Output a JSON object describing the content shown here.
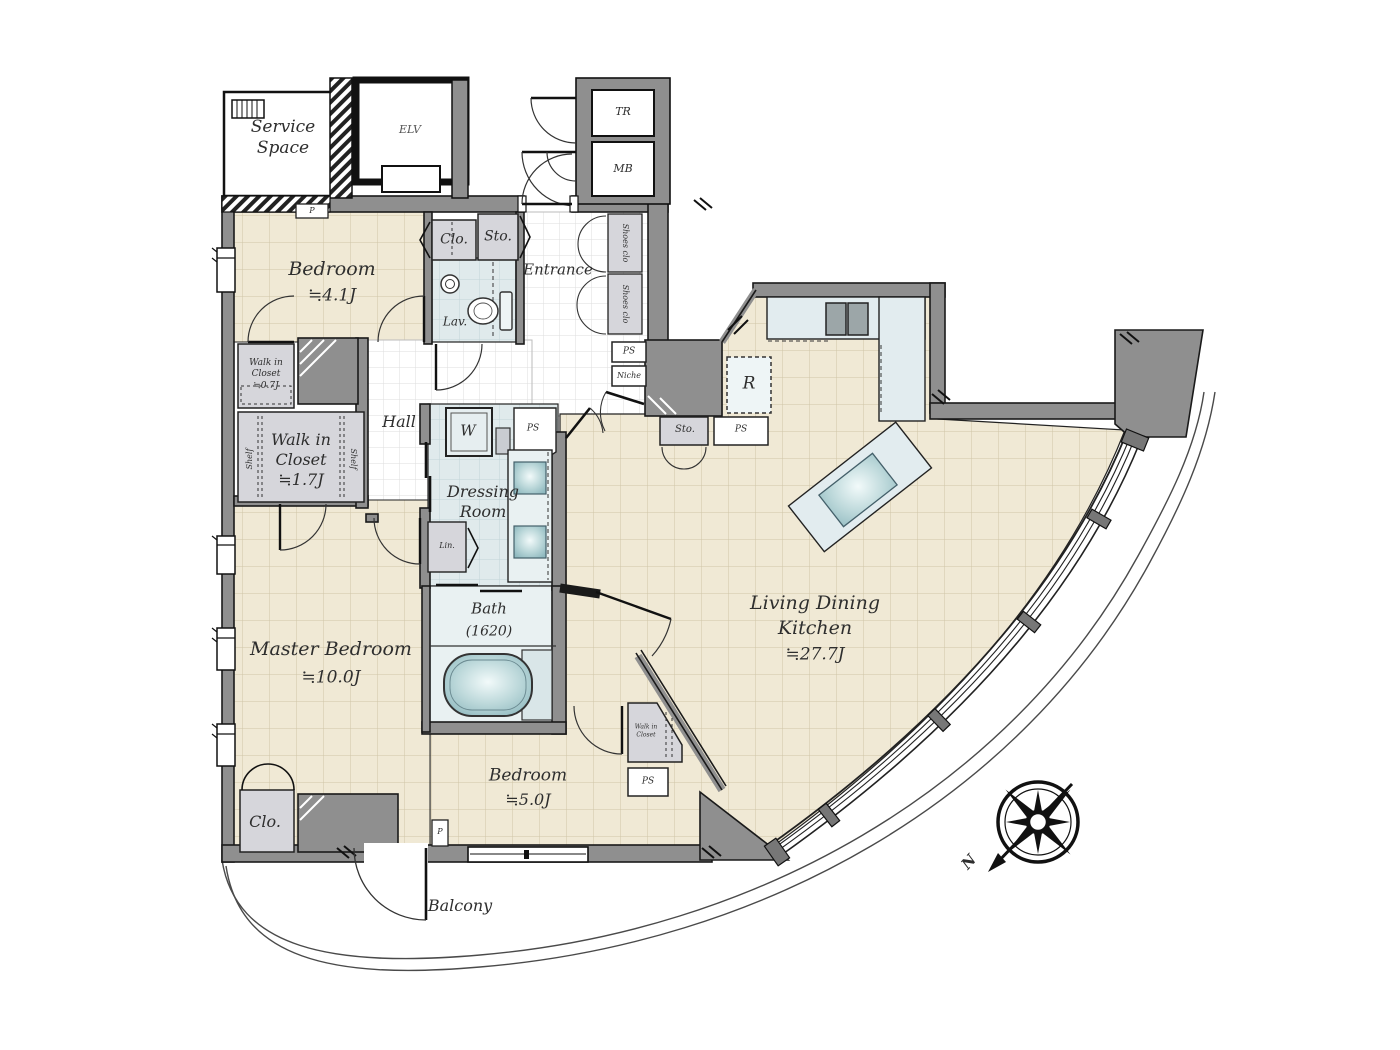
{
  "title": "apartment-floor-plan",
  "colors": {
    "wall": "#8f8f8f",
    "wall_outline": "#1a1a1a",
    "floor_beige": "#f0e9d5",
    "floor_grid": "#cfc5a8",
    "wet_blue": "#e2ecef",
    "closet_gray": "#d6d6db",
    "fixture_teal": "#9fc2c7"
  },
  "labels": {
    "service_space": {
      "line1": "Service",
      "line2": "Space"
    },
    "elv": "ELV",
    "tr": "TR",
    "mb": "MB",
    "p_top": "P",
    "p_bottom": "P",
    "bedroom1": {
      "name": "Bedroom",
      "size": "≒4.1J"
    },
    "clo1": "Clo.",
    "sto1": "Sto.",
    "lav": "Lav.",
    "entrance": "Entrance",
    "shoes_clo1": "Shoes clo",
    "shoes_clo2": "Shoes clo",
    "ps_entrance": "PS",
    "niche": "Niche",
    "hall": "Hall",
    "wic_small": {
      "line1": "Walk in",
      "line2": "Closet",
      "line3": "≒0.7J"
    },
    "wic": {
      "line1": "Walk in",
      "line2": "Closet",
      "line3": "≒1.7J"
    },
    "shelf_left": "Shelf",
    "shelf_right": "Shelf",
    "washer": "W",
    "ps_dressing": "PS",
    "dressing": {
      "line1": "Dressing",
      "line2": "Room"
    },
    "linen": "Lin.",
    "bath": {
      "name": "Bath",
      "size": "(1620)"
    },
    "master": {
      "name": "Master Bedroom",
      "size": "≒10.0J"
    },
    "clo2": "Clo.",
    "bedroom2": {
      "name": "Bedroom",
      "size": "≒5.0J"
    },
    "wic_tri": {
      "line1": "Walk in",
      "line2": "Closet"
    },
    "ps_bedroom": "PS",
    "ldk": {
      "line1": "Living Dining",
      "line2": "Kitchen",
      "line3": "≒27.7J"
    },
    "fridge": "R",
    "sto2": "Sto.",
    "ps_kitchen": "PS",
    "balcony": "Balcony",
    "north": "N"
  }
}
